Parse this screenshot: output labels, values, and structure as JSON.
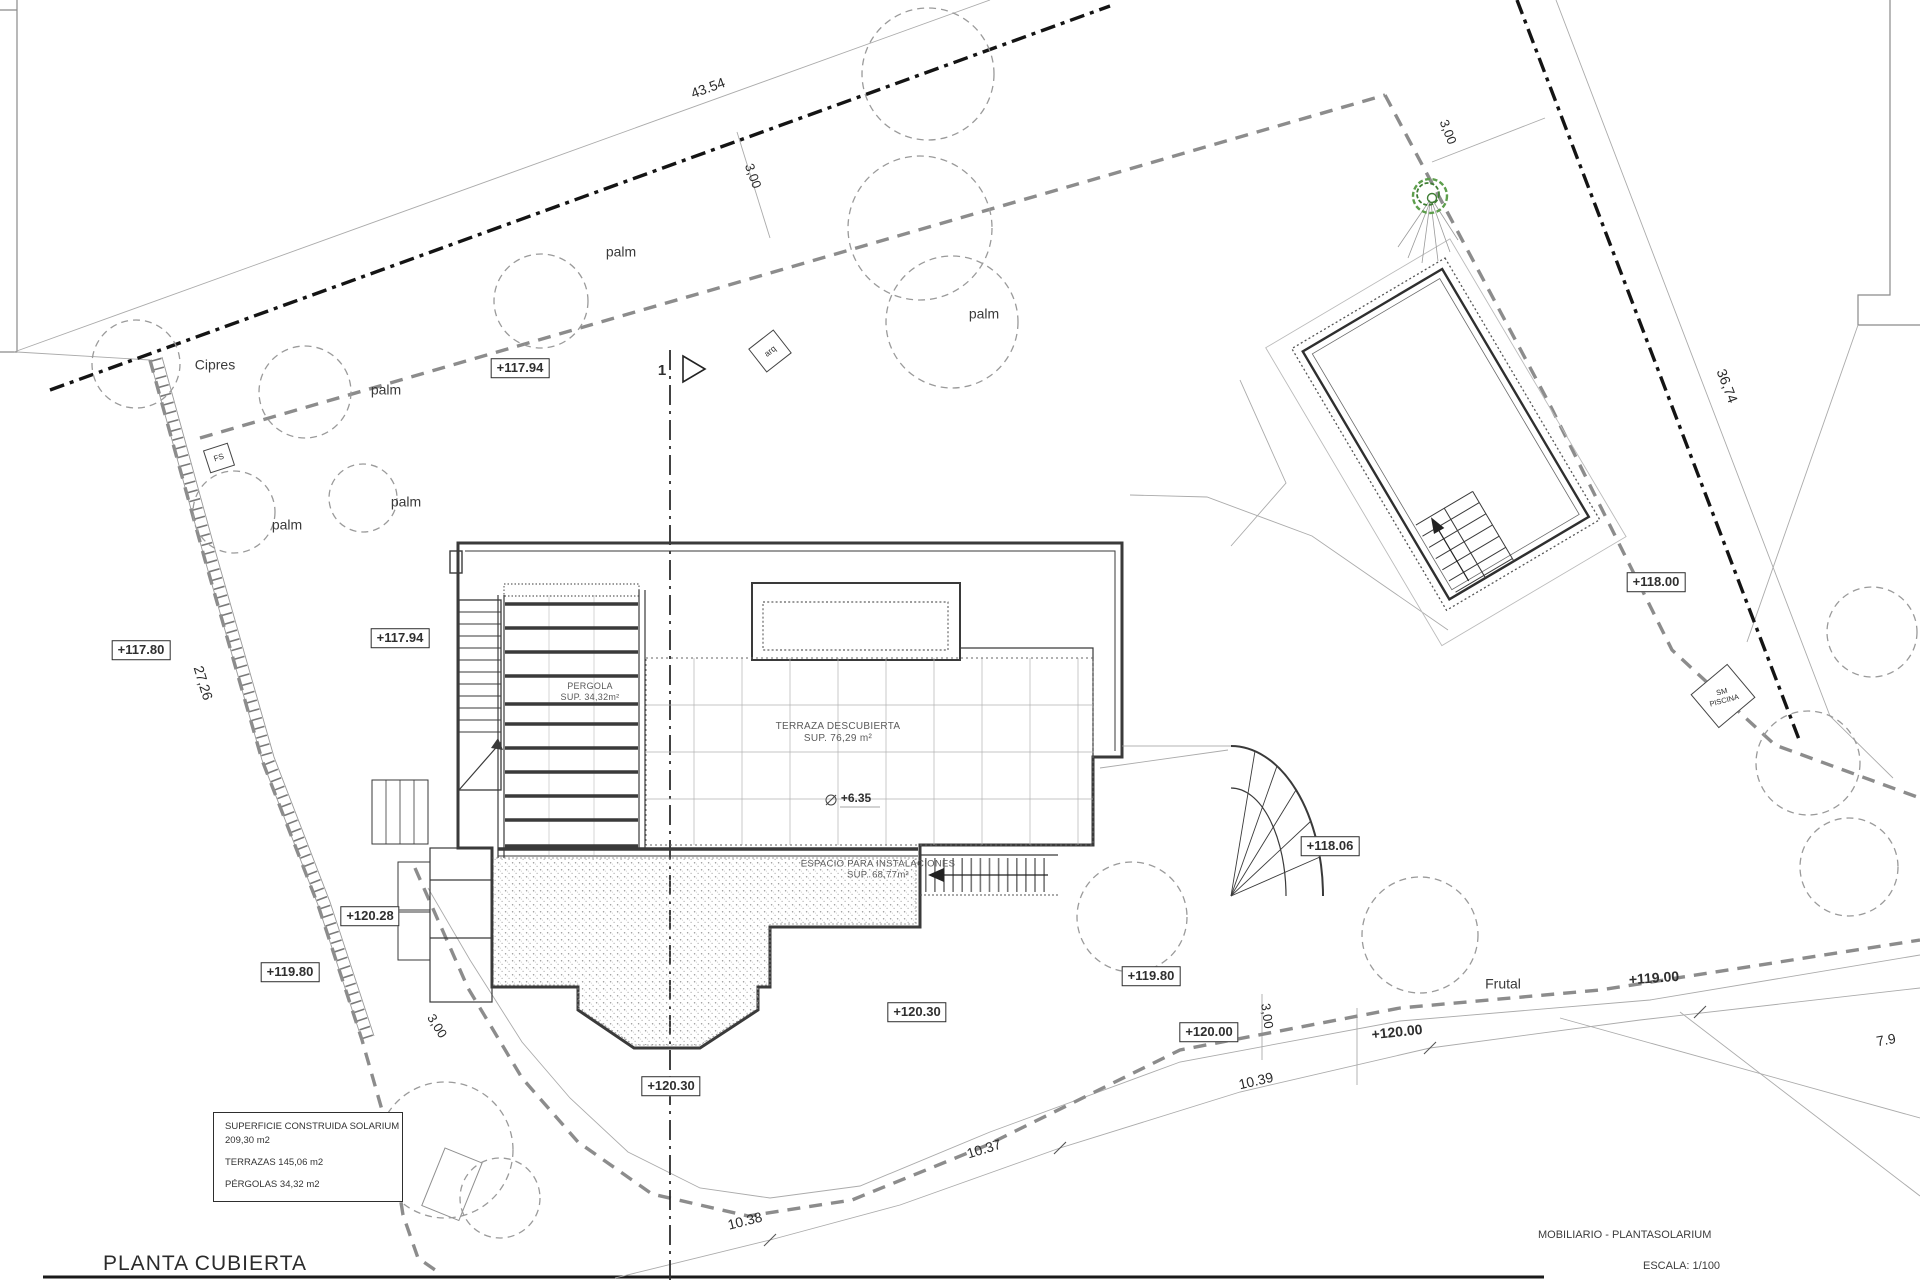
{
  "drawing": {
    "title": "PLANTA CUBIERTA",
    "project": "MOBILIARIO - PLANTASOLARIUM",
    "scale": "ESCALA: 1/100"
  },
  "legend": {
    "lines": [
      "SUPERFICIE CONSTRUIDA SOLARIUM",
      "209,30 m2",
      "TERRAZAS 145,06 m2",
      "PÉRGOLAS  34,32 m2"
    ]
  },
  "colors": {
    "tree_green": "#5d9e4c",
    "tree_green_dark": "#3e7d33",
    "boundary_black": "#141414",
    "setback_gray": "#8c8c8c"
  },
  "labels": [
    {
      "name": "dim-43-54",
      "text": "43.54",
      "x": 708,
      "y": 88,
      "rot": -20,
      "size": 14,
      "style": "dim"
    },
    {
      "name": "dim-3-00-top",
      "text": "3,00",
      "x": 753,
      "y": 176,
      "rot": 70,
      "size": 13,
      "style": "dim"
    },
    {
      "name": "dim-36-74",
      "text": "36,74",
      "x": 1727,
      "y": 386,
      "rot": 69,
      "size": 14,
      "style": "dim"
    },
    {
      "name": "dim-3-00-topright",
      "text": "3,00",
      "x": 1448,
      "y": 132,
      "rot": 69,
      "size": 13,
      "style": "dim"
    },
    {
      "name": "dim-27-26",
      "text": "27,26",
      "x": 203,
      "y": 683,
      "rot": 73,
      "size": 14,
      "style": "dim"
    },
    {
      "name": "dim-3-00-bottomleft",
      "text": "3,00",
      "x": 437,
      "y": 1026,
      "rot": 58,
      "size": 13,
      "style": "dim"
    },
    {
      "name": "dim-3-00-bottomcenter",
      "text": "3,00",
      "x": 1267,
      "y": 1016,
      "rot": 82,
      "size": 13,
      "style": "dim"
    },
    {
      "name": "dim-10-38",
      "text": "10.38",
      "x": 745,
      "y": 1221,
      "rot": -14,
      "size": 14,
      "style": "dim"
    },
    {
      "name": "dim-10-37",
      "text": "10.37",
      "x": 984,
      "y": 1149,
      "rot": -17,
      "size": 14,
      "style": "dim"
    },
    {
      "name": "dim-10-39",
      "text": "10.39",
      "x": 1256,
      "y": 1081,
      "rot": -13,
      "size": 14,
      "style": "dim"
    },
    {
      "name": "dim-7-9",
      "text": "7.9",
      "x": 1886,
      "y": 1040,
      "rot": -10,
      "size": 14,
      "style": "dim"
    },
    {
      "name": "elev-117-94-a",
      "text": "+117.94",
      "x": 520,
      "y": 368,
      "rot": 0,
      "size": 13,
      "style": "boxed"
    },
    {
      "name": "elev-117-94-b",
      "text": "+117.94",
      "x": 400,
      "y": 638,
      "rot": 0,
      "size": 13,
      "style": "boxed"
    },
    {
      "name": "elev-117-80",
      "text": "+117.80",
      "x": 141,
      "y": 650,
      "rot": 0,
      "size": 13,
      "style": "boxed"
    },
    {
      "name": "elev-118-00",
      "text": "+118.00",
      "x": 1656,
      "y": 582,
      "rot": 0,
      "size": 13,
      "style": "boxed"
    },
    {
      "name": "elev-118-06",
      "text": "+118.06",
      "x": 1330,
      "y": 846,
      "rot": 0,
      "size": 13,
      "style": "boxed"
    },
    {
      "name": "elev-120-28",
      "text": "+120.28",
      "x": 370,
      "y": 916,
      "rot": 0,
      "size": 13,
      "style": "boxed"
    },
    {
      "name": "elev-119-80-left",
      "text": "+119.80",
      "x": 290,
      "y": 972,
      "rot": 0,
      "size": 13,
      "style": "boxed"
    },
    {
      "name": "elev-119-80-right",
      "text": "+119.80",
      "x": 1151,
      "y": 976,
      "rot": 0,
      "size": 13,
      "style": "boxed"
    },
    {
      "name": "elev-120-30-a",
      "text": "+120.30",
      "x": 917,
      "y": 1012,
      "rot": 0,
      "size": 13,
      "style": "boxed"
    },
    {
      "name": "elev-120-30-b",
      "text": "+120.30",
      "x": 671,
      "y": 1086,
      "rot": 0,
      "size": 13,
      "style": "boxed"
    },
    {
      "name": "elev-120-00-boxed",
      "text": "+120.00",
      "x": 1209,
      "y": 1032,
      "rot": 0,
      "size": 13,
      "style": "boxed"
    },
    {
      "name": "elev-120-00-plain",
      "text": "+120.00",
      "x": 1397,
      "y": 1032,
      "rot": -6,
      "size": 14,
      "style": "plain"
    },
    {
      "name": "elev-119-00-plain",
      "text": "+119.00",
      "x": 1654,
      "y": 978,
      "rot": -4,
      "size": 14,
      "style": "plain"
    },
    {
      "name": "elev-6-35",
      "text": "+6.35",
      "x": 856,
      "y": 798,
      "rot": 0,
      "size": 12,
      "style": "plain"
    },
    {
      "name": "veg-cipres",
      "text": "Cipres",
      "x": 215,
      "y": 365,
      "rot": 0,
      "size": 14,
      "style": "veg"
    },
    {
      "name": "veg-palm-1",
      "text": "palm",
      "x": 386,
      "y": 390,
      "rot": 0,
      "size": 14,
      "style": "veg"
    },
    {
      "name": "veg-palm-2",
      "text": "palm",
      "x": 621,
      "y": 252,
      "rot": 0,
      "size": 14,
      "style": "veg"
    },
    {
      "name": "veg-palm-3",
      "text": "palm",
      "x": 984,
      "y": 314,
      "rot": 0,
      "size": 14,
      "style": "veg"
    },
    {
      "name": "veg-palm-4",
      "text": "palm",
      "x": 406,
      "y": 502,
      "rot": 0,
      "size": 14,
      "style": "veg"
    },
    {
      "name": "veg-palm-5",
      "text": "palm",
      "x": 287,
      "y": 525,
      "rot": 0,
      "size": 14,
      "style": "veg"
    },
    {
      "name": "veg-frutal",
      "text": "Frutal",
      "x": 1503,
      "y": 984,
      "rot": 0,
      "size": 14,
      "style": "veg"
    },
    {
      "name": "area-pergola",
      "text": "PERGOLA\nSUP. 34,32m²",
      "x": 590,
      "y": 692,
      "rot": 0,
      "size": 9,
      "style": "area"
    },
    {
      "name": "area-terraza",
      "text": "TERRAZA DESCUBIERTA\nSUP. 76,29 m²",
      "x": 838,
      "y": 733,
      "rot": 0,
      "size": 10,
      "style": "area"
    },
    {
      "name": "area-espacio",
      "text": "ESPACIO PARA INSTALACIONES\nSUP. 68,77m²",
      "x": 878,
      "y": 870,
      "rot": 0,
      "size": 9.5,
      "style": "area"
    },
    {
      "name": "tag-fs",
      "text": "FS",
      "x": 219,
      "y": 458,
      "rot": -18,
      "size": 8,
      "style": "tag",
      "w": 24,
      "h": 22
    },
    {
      "name": "tag-arq",
      "text": "arq",
      "x": 770,
      "y": 351,
      "rot": -38,
      "size": 8.5,
      "style": "tag",
      "w": 30,
      "h": 28
    },
    {
      "name": "tag-sm-piscina",
      "text": "SM\nPISCINA",
      "x": 1723,
      "y": 696,
      "rot": -40,
      "textRot": 25,
      "size": 7.5,
      "style": "tag",
      "w": 46,
      "h": 42
    },
    {
      "name": "section-marker-1",
      "text": "1",
      "x": 662,
      "y": 371,
      "rot": 0,
      "size": 15,
      "style": "plain"
    }
  ]
}
